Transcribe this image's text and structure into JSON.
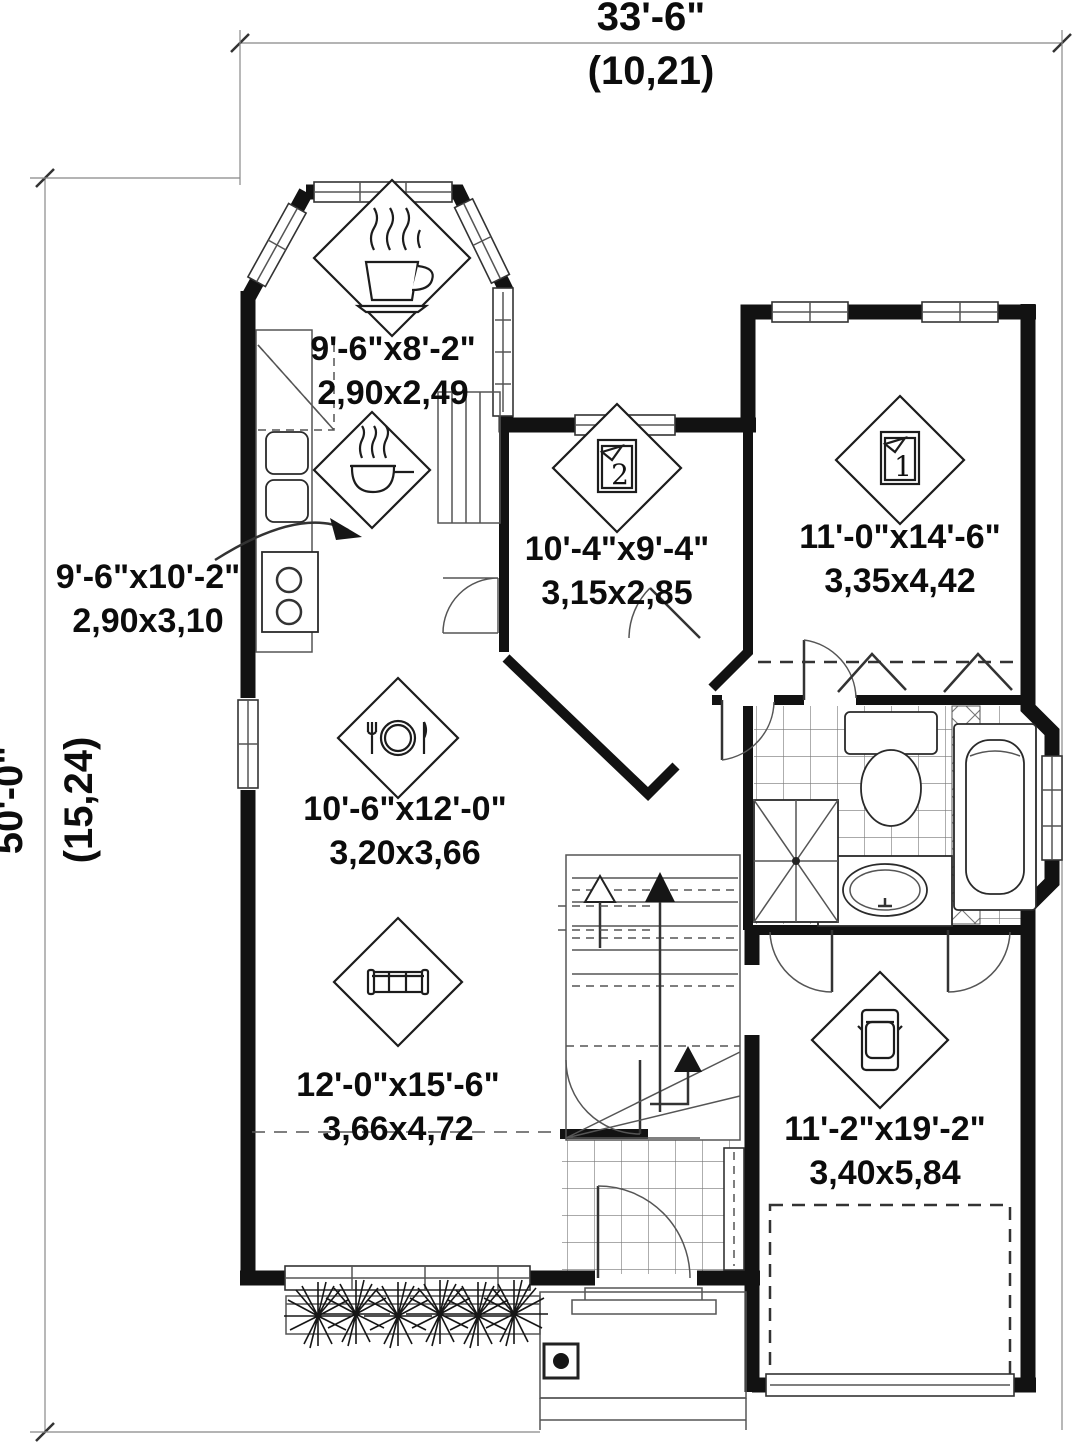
{
  "plan": {
    "overall_dimensions": {
      "width_imperial": "33'-6\"",
      "width_metric": "(10,21)",
      "depth_imperial": "50'-0\"",
      "depth_metric": "(15,24)"
    },
    "rooms": {
      "breakfast_nook": {
        "icon": "coffee-cup-icon",
        "imperial": "9'-6\"x8'-2\"",
        "metric": "2,90x2,49"
      },
      "kitchen": {
        "icon": "cooking-pot-icon",
        "imperial": "9'-6\"x10'-2\"",
        "metric": "2,90x3,10"
      },
      "bedroom2": {
        "icon": "bed-icon",
        "number": "2",
        "imperial": "10'-4\"x9'-4\"",
        "metric": "3,15x2,85"
      },
      "bedroom1": {
        "icon": "bed-icon",
        "number": "1",
        "imperial": "11'-0\"x14'-6\"",
        "metric": "3,35x4,42"
      },
      "dining": {
        "icon": "place-setting-icon",
        "imperial": "10'-6\"x12'-0\"",
        "metric": "3,20x3,66"
      },
      "living": {
        "icon": "sofa-icon",
        "imperial": "12'-0\"x15'-6\"",
        "metric": "3,66x4,72"
      },
      "garage": {
        "icon": "car-icon",
        "imperial": "11'-2\"x19'-2\"",
        "metric": "3,40x5,84"
      }
    },
    "colors": {
      "wall": "#121212",
      "line": "#444444",
      "background": "#ffffff"
    }
  }
}
